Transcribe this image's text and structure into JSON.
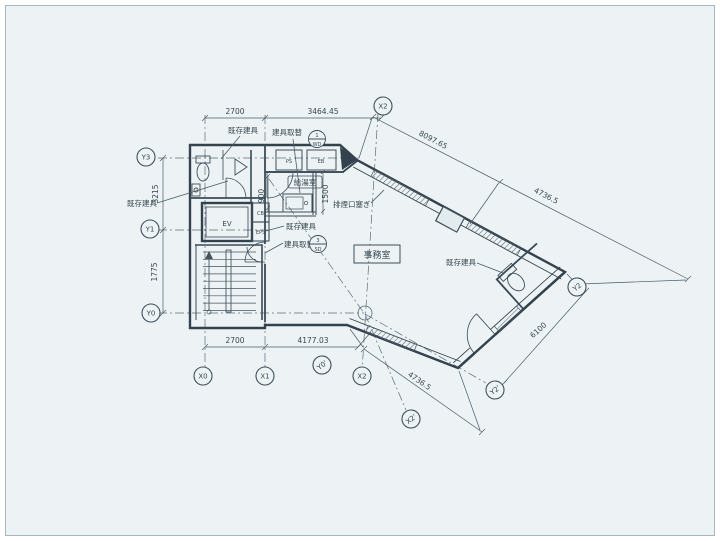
{
  "drawing": {
    "type": "architectural floor plan (scanned)",
    "paper_color": "#edf3f5",
    "line_color": "#3e4e59"
  },
  "rooms": {
    "office": "事務室",
    "pantry": "給湯室",
    "elevator": "EV",
    "shaft_top": "PS",
    "shaft_right": "EB",
    "closet_upper": "CB",
    "closet_lower": "EPS"
  },
  "annotations": {
    "existing_fixture": "既存建具",
    "fixture_replace": "建具取替",
    "smoke_vent": "排煙口塞ぎ",
    "door_mark_wd_no": "1",
    "door_mark_wd": "WD",
    "door_mark_sd_no": "3",
    "door_mark_sd": "SD"
  },
  "dimensions": {
    "top": [
      "2700",
      "3464.45"
    ],
    "bottom": [
      "2700",
      "4177.03"
    ],
    "left": [
      "3215",
      "1775"
    ],
    "diag_upper": [
      "8097.65",
      "4736.5"
    ],
    "diag_lower": "4736.5",
    "right_edge": "6100",
    "pantry_width": "900",
    "pantry_depth": "1500"
  },
  "grid": {
    "x0": "X0",
    "x1": "X1",
    "x2": "X2",
    "y0": "Y0",
    "y1": "Y1",
    "y2": "Y2",
    "y3": "Y3",
    "x2p": "X2'",
    "y0p": "Y0'",
    "y2p": "Y2'"
  }
}
